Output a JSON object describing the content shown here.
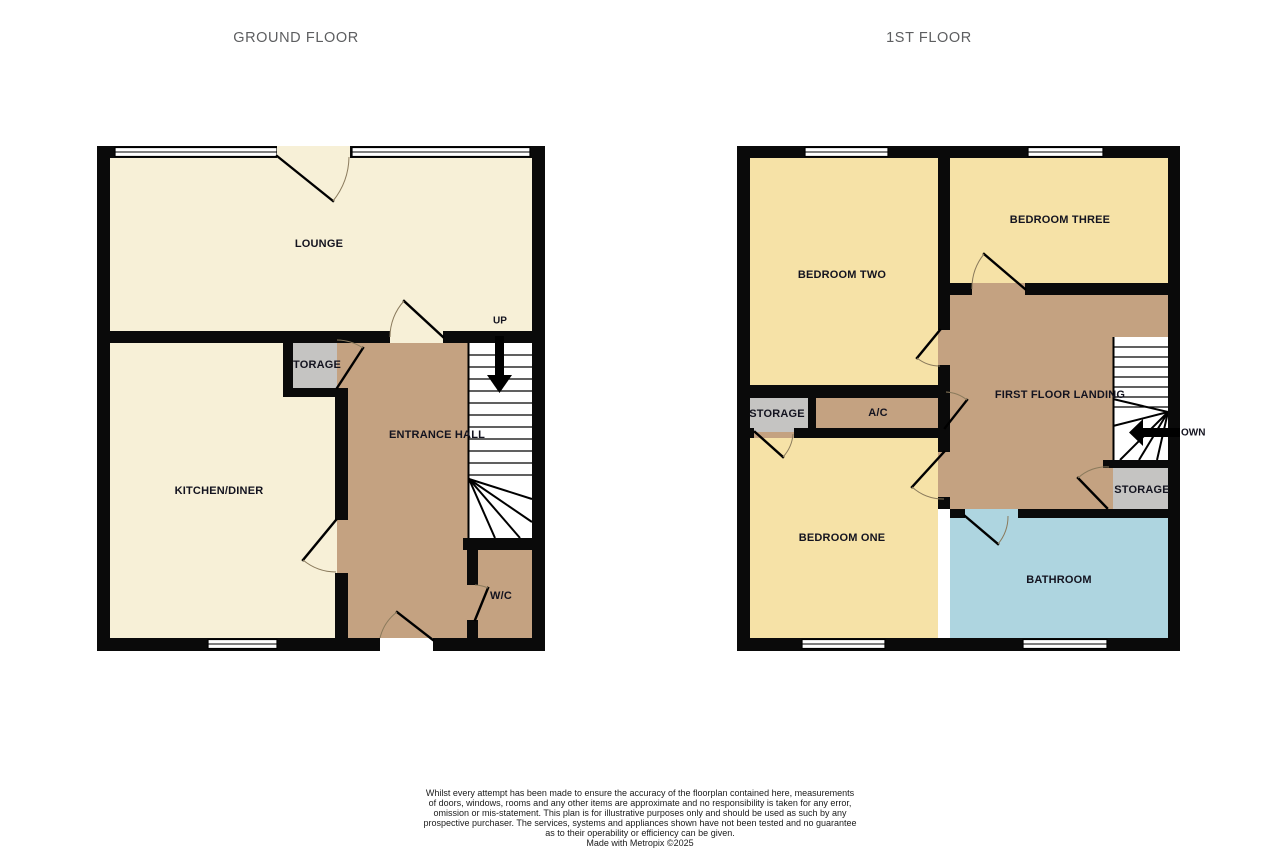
{
  "headers": {
    "ground_floor": "GROUND FLOOR",
    "first_floor": "1ST FLOOR"
  },
  "ground_floor": {
    "labels": {
      "lounge": "LOUNGE",
      "kitchen_diner": "KITCHEN/DINER",
      "entrance_hall": "ENTRANCE HALL",
      "storage": "TORAGE",
      "wc": "W/C",
      "stairs_up": "UP"
    }
  },
  "first_floor": {
    "labels": {
      "bedroom_two": "BEDROOM TWO",
      "bedroom_three": "BEDROOM THREE",
      "landing": "FIRST FLOOR LANDING",
      "storage_left": "STORAGE",
      "ac": "A/C",
      "bedroom_one": "BEDROOM ONE",
      "storage_right": "STORAGE",
      "bathroom": "BATHROOM",
      "stairs_down": "OWN"
    }
  },
  "disclaimer": {
    "lines": [
      "Whilst every attempt has been made to ensure the accuracy of the floorplan contained here, measurements",
      "of doors, windows, rooms and any other items are approximate and no responsibility is taken for any error,",
      "omission or mis-statement. This plan is for illustrative purposes only and should be used as such by any",
      "prospective purchaser. The services, systems and appliances shown have not been tested and no guarantee",
      "as to their operability or efficiency can be given.",
      "Made with Metropix ©2025"
    ]
  },
  "colors": {
    "room_cream": "#f7f0d7",
    "room_yellow": "#f6e2a7",
    "room_tan": "#c4a281",
    "room_blue": "#aed5e0",
    "room_gray": "#c5c4c2",
    "wall": "#0a0a0a",
    "door_arc": "#8a7a5c",
    "label_text": "#13131f",
    "header_text": "#5d5e60",
    "disclaimer_text": "#1b1b1b"
  }
}
